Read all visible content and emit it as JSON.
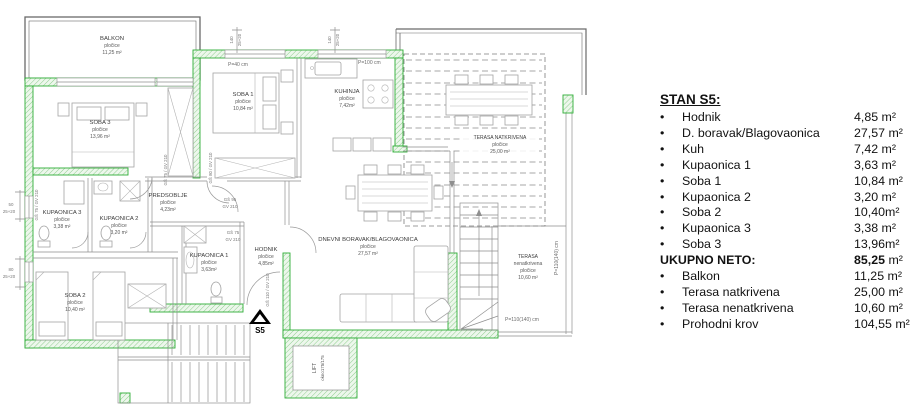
{
  "colors": {
    "wall_green": "#2fae38",
    "wall_fill": "#edf7ec",
    "line_gray": "#8f8f8f",
    "outline_dark": "#6a6a6a",
    "text_dark": "#3c3c3c",
    "legend_text": "#121212"
  },
  "plan": {
    "marker": "S5",
    "lift": {
      "name": "LIFT",
      "shaft": "okno175/175"
    },
    "rooms": {
      "balkon": {
        "name": "BALKON",
        "finish": "pločice",
        "area": "11,25 m²"
      },
      "soba3": {
        "name": "SOBA 3",
        "finish": "pločice",
        "area": "13,96 m²"
      },
      "soba1": {
        "name": "SOBA 1",
        "finish": "pločice",
        "area": "10,84 m²"
      },
      "kuhinja": {
        "name": "KUHINJA",
        "finish": "pločice",
        "area": "7,42m²"
      },
      "predsoblje": {
        "name": "PREDSOBLJE",
        "finish": "pločice",
        "area": "4,23m²"
      },
      "kupaonica3": {
        "name": "KUPAONICA 3",
        "finish": "pločice",
        "area": "3,38 m²"
      },
      "kupaonica2": {
        "name": "KUPAONICA 2",
        "finish": "pločice",
        "area": "3,20 m²"
      },
      "kupaonica1": {
        "name": "KUPAONICA 1",
        "finish": "pločice",
        "area": "3,63m²"
      },
      "hodnik": {
        "name": "HODNIK",
        "finish": "pločice",
        "area": "4,85m²"
      },
      "soba2": {
        "name": "SOBA 2",
        "finish": "pločice",
        "area": "10,40 m²"
      },
      "dnevni": {
        "name": "DNEVNI BORAVAK/BLAGOVAONICA",
        "finish": "pločice",
        "area": "27,57 m²"
      },
      "terasa_natkrivena": {
        "name": "TERASA NATKRIVENA",
        "finish": "pločice",
        "area": "25,00 m²"
      },
      "terasa_nenatkrivena": {
        "name": "TERASA",
        "name2": "nenatkrivena",
        "finish": "pločice",
        "area": "10,60 m²"
      }
    },
    "annotations": {
      "p40": "P=40 cm",
      "p100": "P=100 cm",
      "p110": "P=110(140) cm",
      "dim140": "140",
      "dim2520": "25+20",
      "dim50": "50",
      "dim80": "80",
      "gs75gv210": "GŠ 75 / GV 210",
      "gs80gv210": "GŠ 80 / GV 210",
      "gs110gv210": "GŠ 110 / GV 210",
      "gs95": "GŠ 95",
      "gs75": "GŠ 75",
      "gv210": "GV 210"
    }
  },
  "legend": {
    "title": "STAN S5:",
    "rows": [
      {
        "label": "Hodnik",
        "value": "4,85 m²"
      },
      {
        "label": "D. boravak/Blagovaonica",
        "value": "27,57 m²"
      },
      {
        "label": "Kuh",
        "value": "7,42 m²"
      },
      {
        "label": "Kupaonica 1",
        "value": "3,63 m²"
      },
      {
        "label": "Soba 1",
        "value": "10,84 m²"
      },
      {
        "label": "Kupaonica 2",
        "value": "3,20 m²"
      },
      {
        "label": "Soba 2",
        "value": "10,40m²"
      },
      {
        "label": "Kupaonica 3",
        "value": "3,38 m²"
      },
      {
        "label": "Soba 3",
        "value": "13,96m²"
      }
    ],
    "total": {
      "label": "UKUPNO NETO:",
      "value": "85,25",
      "unit": " m²"
    },
    "extras": [
      {
        "label": "Balkon",
        "value": "11,25 m²"
      },
      {
        "label": "Terasa natkrivena",
        "value": "25,00 m²"
      },
      {
        "label": "Terasa nenatkrivena",
        "value": "10,60 m²"
      },
      {
        "label": "Prohodni krov",
        "value": "104,55 m²"
      }
    ]
  }
}
